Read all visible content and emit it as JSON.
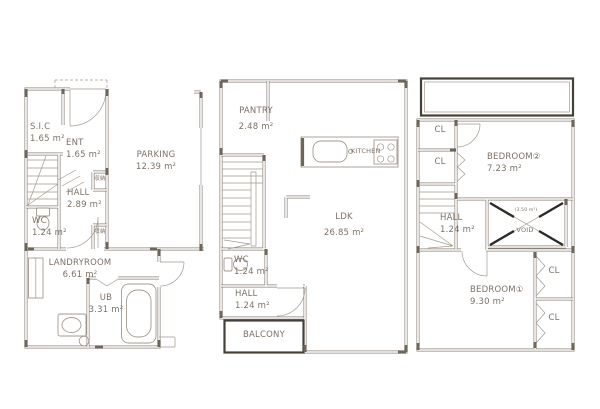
{
  "colors": {
    "paper": "#ffffff",
    "wall": "#8b8277",
    "line": "#a39a8e",
    "text": "#7c7166",
    "dark": "#45403a",
    "accent": "#6e6659",
    "voidx": "#2e2a25"
  },
  "floor1": {
    "sic": {
      "name": "S.I.C",
      "area": "1.65 m²"
    },
    "ent": {
      "name": "ENT",
      "area": "1.65 m²"
    },
    "parking": {
      "name": "PARKING",
      "area": "12.39 m²"
    },
    "hall": {
      "name": "HALL",
      "area": "2.89 m²"
    },
    "wc": {
      "name": "WC",
      "area": "1.24 m²"
    },
    "storage_upper": {
      "name": "収納"
    },
    "storage_lower": {
      "name": "収納"
    },
    "landryroom": {
      "name": "LANDRYROOM",
      "area": "6.61 m²"
    },
    "ub": {
      "name": "UB",
      "area": "3.31 m²"
    }
  },
  "floor2": {
    "pantry": {
      "name": "PANTRY",
      "area": "2.48 m²"
    },
    "kitchen": {
      "name": "KITCHEN"
    },
    "ldk": {
      "name": "LDK",
      "area": "26.85 m²"
    },
    "wc": {
      "name": "WC",
      "area": "1.24 m²"
    },
    "hall": {
      "name": "HALL",
      "area": "1.24 m²"
    },
    "balcony": {
      "name": "BALCONY"
    }
  },
  "floor3": {
    "cl_a": {
      "name": "CL"
    },
    "cl_b": {
      "name": "CL"
    },
    "bedroom2": {
      "name": "BEDROOM②",
      "area": "7.23 m²"
    },
    "hall": {
      "name": "HALL",
      "area": "1.24 m²"
    },
    "void": {
      "name": "VOID",
      "note": "(3.50 m²)"
    },
    "bedroom1": {
      "name": "BEDROOM①",
      "area": "9.30 m²"
    },
    "cl_c": {
      "name": "CL"
    },
    "cl_d": {
      "name": "CL"
    }
  }
}
